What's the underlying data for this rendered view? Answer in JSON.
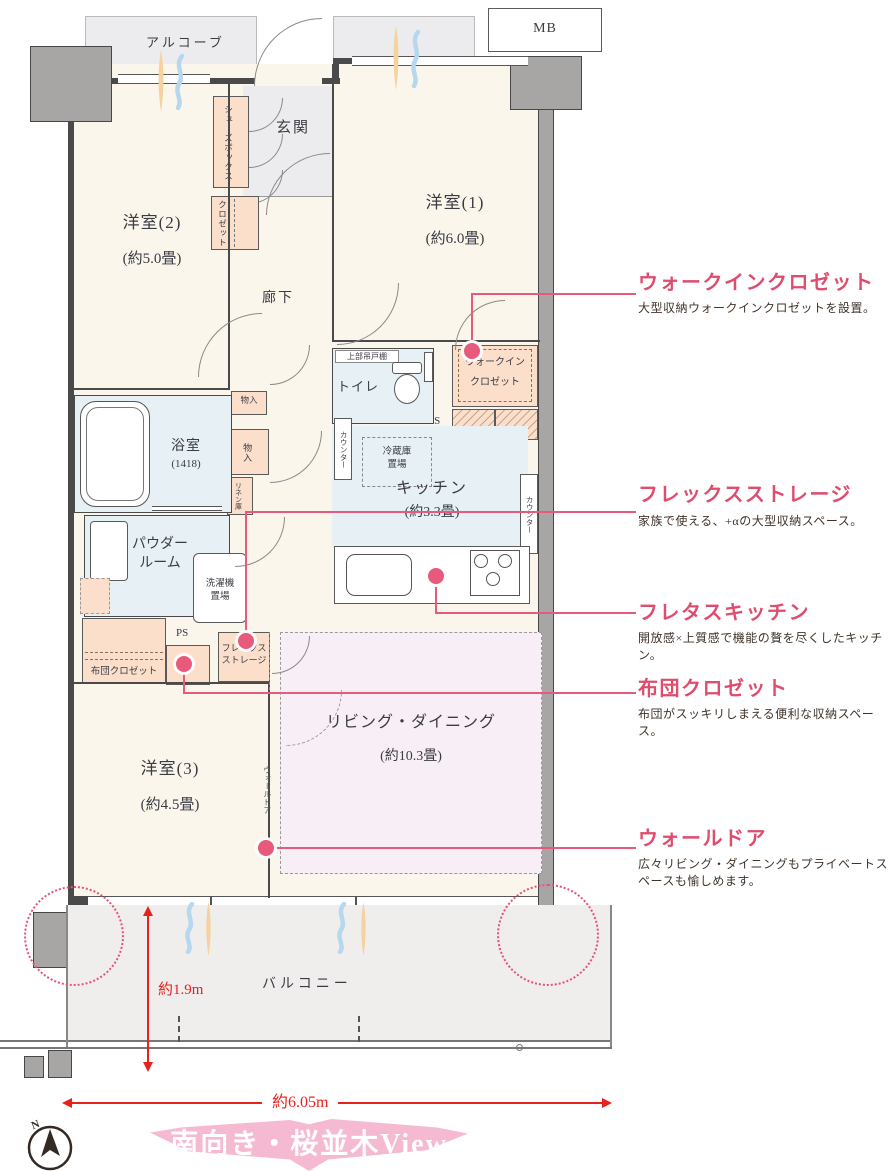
{
  "plan": {
    "common": {
      "alcove": "アルコーブ",
      "meter_box": "MB",
      "entrance": "玄関",
      "hallway": "廊下",
      "balcony": "バルコニー"
    },
    "rooms": {
      "western1": {
        "name": "洋室(1)",
        "size": "(約6.0畳)"
      },
      "western2": {
        "name": "洋室(2)",
        "size": "(約5.0畳)"
      },
      "western3": {
        "name": "洋室(3)",
        "size": "(約4.5畳)"
      },
      "living_dining": {
        "name": "リビング・ダイニング",
        "size": "(約10.3畳)"
      },
      "kitchen": {
        "name": "キッチン",
        "size": "(約3.3畳)"
      },
      "bathroom": {
        "name": "浴室",
        "size": "(1418)"
      },
      "powder_room": {
        "line1": "パウダー",
        "line2": "ルーム"
      },
      "toilet": "トイレ"
    },
    "storage": {
      "shoes_box": "シューズボックス",
      "closet": "クロゼット",
      "walk_in_closet": {
        "line1": "ウォークイン",
        "line2": "クロゼット"
      },
      "storage1": "物入",
      "storage2": "物入",
      "linen": "リネン庫",
      "futon_closet": "布団クロゼット",
      "flex_storage": {
        "line1": "フレックス",
        "line2": "ストレージ"
      }
    },
    "fixtures": {
      "upper_cabinet": "上部吊戸棚",
      "counter_left": "カウンター",
      "counter_right": "カウンター",
      "fridge_space": {
        "line1": "冷蔵庫",
        "line2": "置場"
      },
      "washer_space": {
        "line1": "洗濯機",
        "line2": "置場"
      },
      "ps1": "PS",
      "ps2": "PS",
      "wall_door": "ウォールドア"
    },
    "dimensions": {
      "depth": "約1.9m",
      "width": "約6.05m"
    },
    "compass_north": "N"
  },
  "annotations": [
    {
      "title": "ウォークインクロゼット",
      "body": "大型収納ウォークインクロゼットを設置。"
    },
    {
      "title": "フレックスストレージ",
      "body": "家族で使える、+αの大型収納スペース。"
    },
    {
      "title": "フレタスキッチン",
      "body": "開放感×上質感で機能の贅を尽くしたキッチン。"
    },
    {
      "title": "布団クロゼット",
      "body": "布団がスッキリしまえる便利な収納スペース。"
    },
    {
      "title": "ウォールドア",
      "body": "広々リビング・ダイニングもプライベートスペースも愉しめます。"
    }
  ],
  "caption": "南向き・桜並木View",
  "colors": {
    "accent_pink": "#df4c6e",
    "dimension_red": "#e8211d",
    "storage_peach": "#fbdfca",
    "wet_area_blue": "#e7f0f4",
    "ld_highlight": "#f8eff6",
    "banner_pink": "#f5bad2"
  }
}
